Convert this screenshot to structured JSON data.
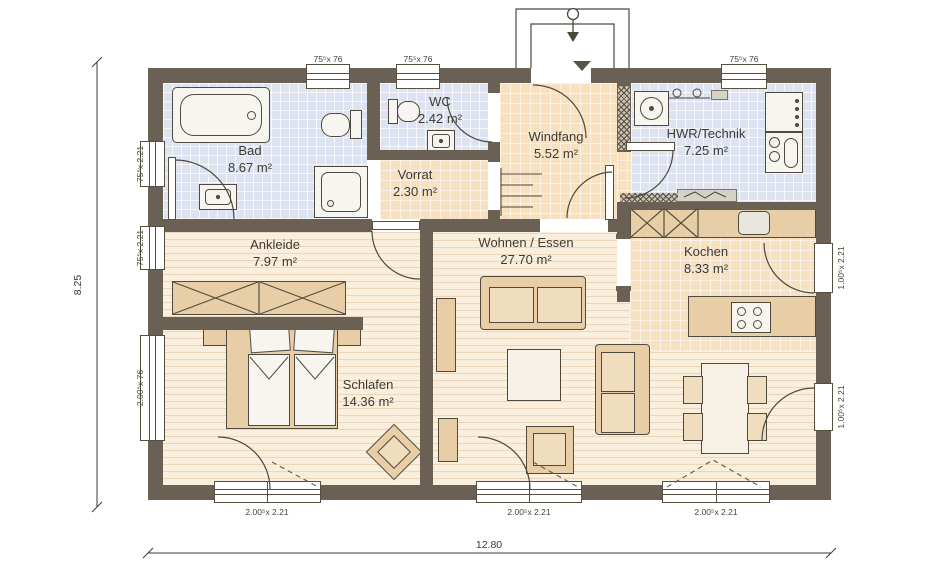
{
  "rooms": [
    {
      "name": "Bad",
      "area": "8.67 m²"
    },
    {
      "name": "WC",
      "area": "2.42 m²"
    },
    {
      "name": "Vorrat",
      "area": "2.30 m²"
    },
    {
      "name": "Windfang",
      "area": "5.52 m²"
    },
    {
      "name": "HWR/Technik",
      "area": "7.25 m²"
    },
    {
      "name": "Ankleide",
      "area": "7.97 m²"
    },
    {
      "name": "Wohnen / Essen",
      "area": "27.70 m²"
    },
    {
      "name": "Kochen",
      "area": "8.33 m²"
    },
    {
      "name": "Schlafen",
      "area": "14.36 m²"
    }
  ],
  "dimensions": {
    "total_width": "12.80",
    "total_height": "8.25"
  },
  "openings": {
    "top_windows": [
      "75⁵x 76",
      "75⁵x 76",
      "75⁵x 76"
    ],
    "left_windows": [
      "75⁵x 2.21",
      "75⁵x 2.21",
      "2.00⁵x 76"
    ],
    "right_doors": [
      "1.00⁵x 2.21",
      "1.00⁵x 2.21"
    ],
    "bottom_windows": [
      "2.00⁵x 2.21",
      "2.00⁵x 2.21",
      "2.00⁵x 2.21"
    ]
  },
  "colors": {
    "wall": "#6a6054",
    "tile_blue": "#dde3f1",
    "tile_peach": "#f7e1c1",
    "wood": "#faeedd",
    "furniture": "#e8cea6"
  }
}
